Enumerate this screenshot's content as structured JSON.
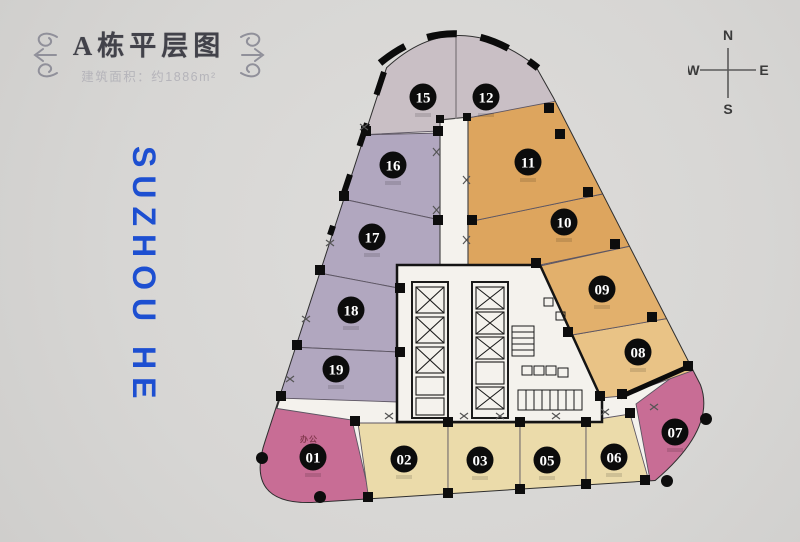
{
  "header": {
    "title": "A栋平层图",
    "subtitle": "建筑面积：约1886m²"
  },
  "watermark": {
    "text": "SUZHOU HE",
    "color": "#1d4fd1"
  },
  "compass": {
    "north": "N",
    "south": "S",
    "east": "E",
    "west": "W"
  },
  "floorplan": {
    "unit_note": "办公",
    "units": [
      {
        "id": "01",
        "label": "01",
        "category": "pink",
        "cx": 313,
        "cy": 457
      },
      {
        "id": "02",
        "label": "02",
        "category": "cream",
        "cx": 404,
        "cy": 459
      },
      {
        "id": "03",
        "label": "03",
        "category": "cream",
        "cx": 480,
        "cy": 460
      },
      {
        "id": "05",
        "label": "05",
        "category": "cream",
        "cx": 547,
        "cy": 460
      },
      {
        "id": "06",
        "label": "06",
        "category": "cream",
        "cx": 614,
        "cy": 457
      },
      {
        "id": "07",
        "label": "07",
        "category": "pink",
        "cx": 675,
        "cy": 432
      },
      {
        "id": "08",
        "label": "08",
        "category": "orange_pale",
        "cx": 638,
        "cy": 352
      },
      {
        "id": "09",
        "label": "09",
        "category": "orange_light",
        "cx": 602,
        "cy": 289
      },
      {
        "id": "10",
        "label": "10",
        "category": "orange",
        "cx": 564,
        "cy": 222
      },
      {
        "id": "11",
        "label": "11",
        "category": "orange",
        "cx": 528,
        "cy": 162
      },
      {
        "id": "12",
        "label": "12",
        "category": "mauve",
        "cx": 486,
        "cy": 97
      },
      {
        "id": "15",
        "label": "15",
        "category": "mauve",
        "cx": 423,
        "cy": 97
      },
      {
        "id": "16",
        "label": "16",
        "category": "purple",
        "cx": 393,
        "cy": 165
      },
      {
        "id": "17",
        "label": "17",
        "category": "purple",
        "cx": 372,
        "cy": 237
      },
      {
        "id": "18",
        "label": "18",
        "category": "purple",
        "cx": 351,
        "cy": 310
      },
      {
        "id": "19",
        "label": "19",
        "category": "purple",
        "cx": 336,
        "cy": 369
      }
    ],
    "colors": {
      "mauve": "#c9bfc5",
      "purple": "#b1a7bf",
      "orange": "#dda55e",
      "orange_light": "#e2b06c",
      "orange_pale": "#e9c386",
      "cream": "#ebdbaa",
      "pink": "#c86d95",
      "core": "#f4f2ed",
      "wall": "#141414"
    }
  }
}
